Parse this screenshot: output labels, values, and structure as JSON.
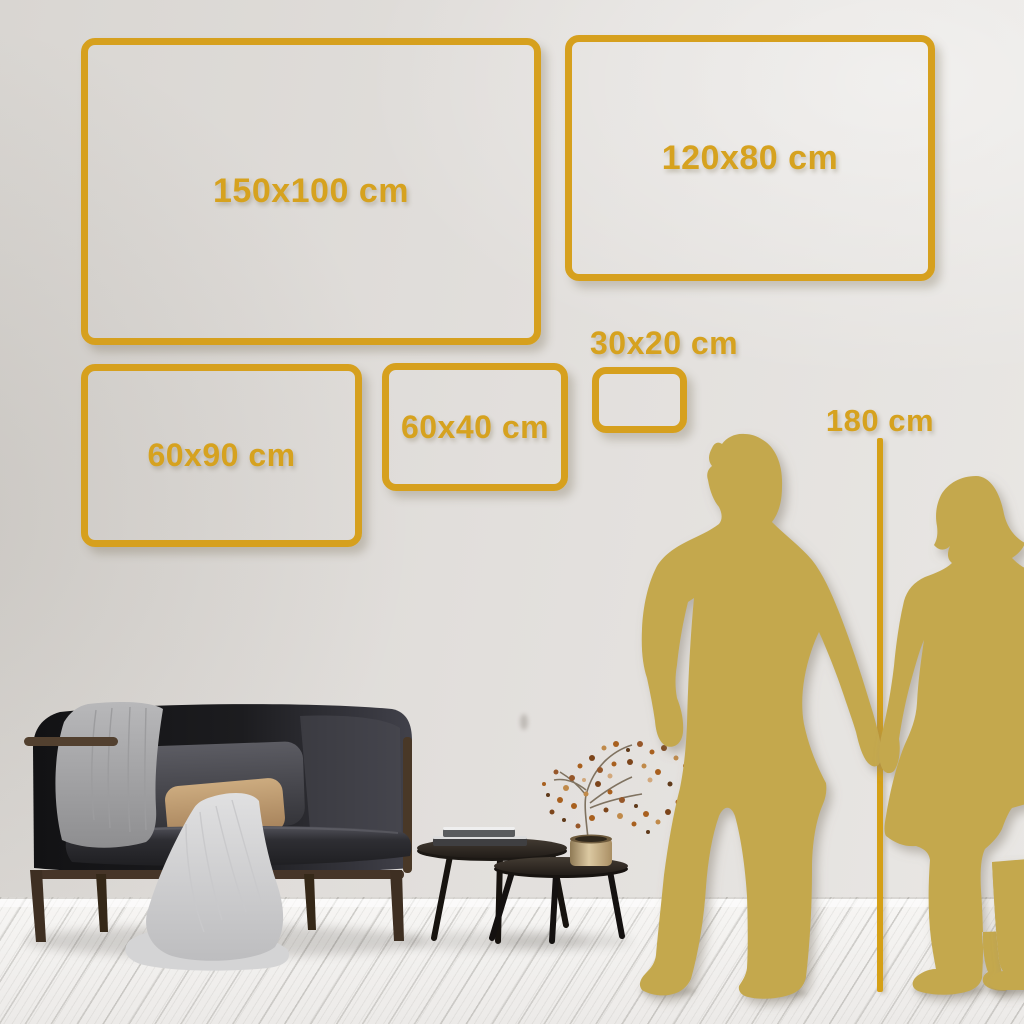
{
  "size_guide": {
    "unit": "cm",
    "frames": [
      {
        "label": "150x100 cm",
        "width_cm": 150,
        "height_cm": 100
      },
      {
        "label": "120x80 cm",
        "width_cm": 120,
        "height_cm": 80
      },
      {
        "label": "60x90 cm",
        "width_cm": 60,
        "height_cm": 90
      },
      {
        "label": "60x40 cm",
        "width_cm": 60,
        "height_cm": 40
      },
      {
        "label": "30x20 cm",
        "width_cm": 30,
        "height_cm": 20
      }
    ],
    "height_marker": {
      "label": "180 cm",
      "value_cm": 180
    }
  },
  "colors": {
    "accent_gold": "#d6a01e",
    "silhouette_gold": "#c4a84e",
    "wall": "#e2dfdc",
    "floor": "#f5f4f2"
  },
  "scene": {
    "objects": [
      "dark-sofa-with-blanket-and-cushions",
      "gray-throw-blanket",
      "beige-pillow",
      "nesting-coffee-tables",
      "stacked-books",
      "brass-vase-with-dried-plant",
      "man-silhouette",
      "woman-silhouette",
      "height-reference-line"
    ],
    "figures_description": "couple holding hands beside 180 cm height line"
  }
}
